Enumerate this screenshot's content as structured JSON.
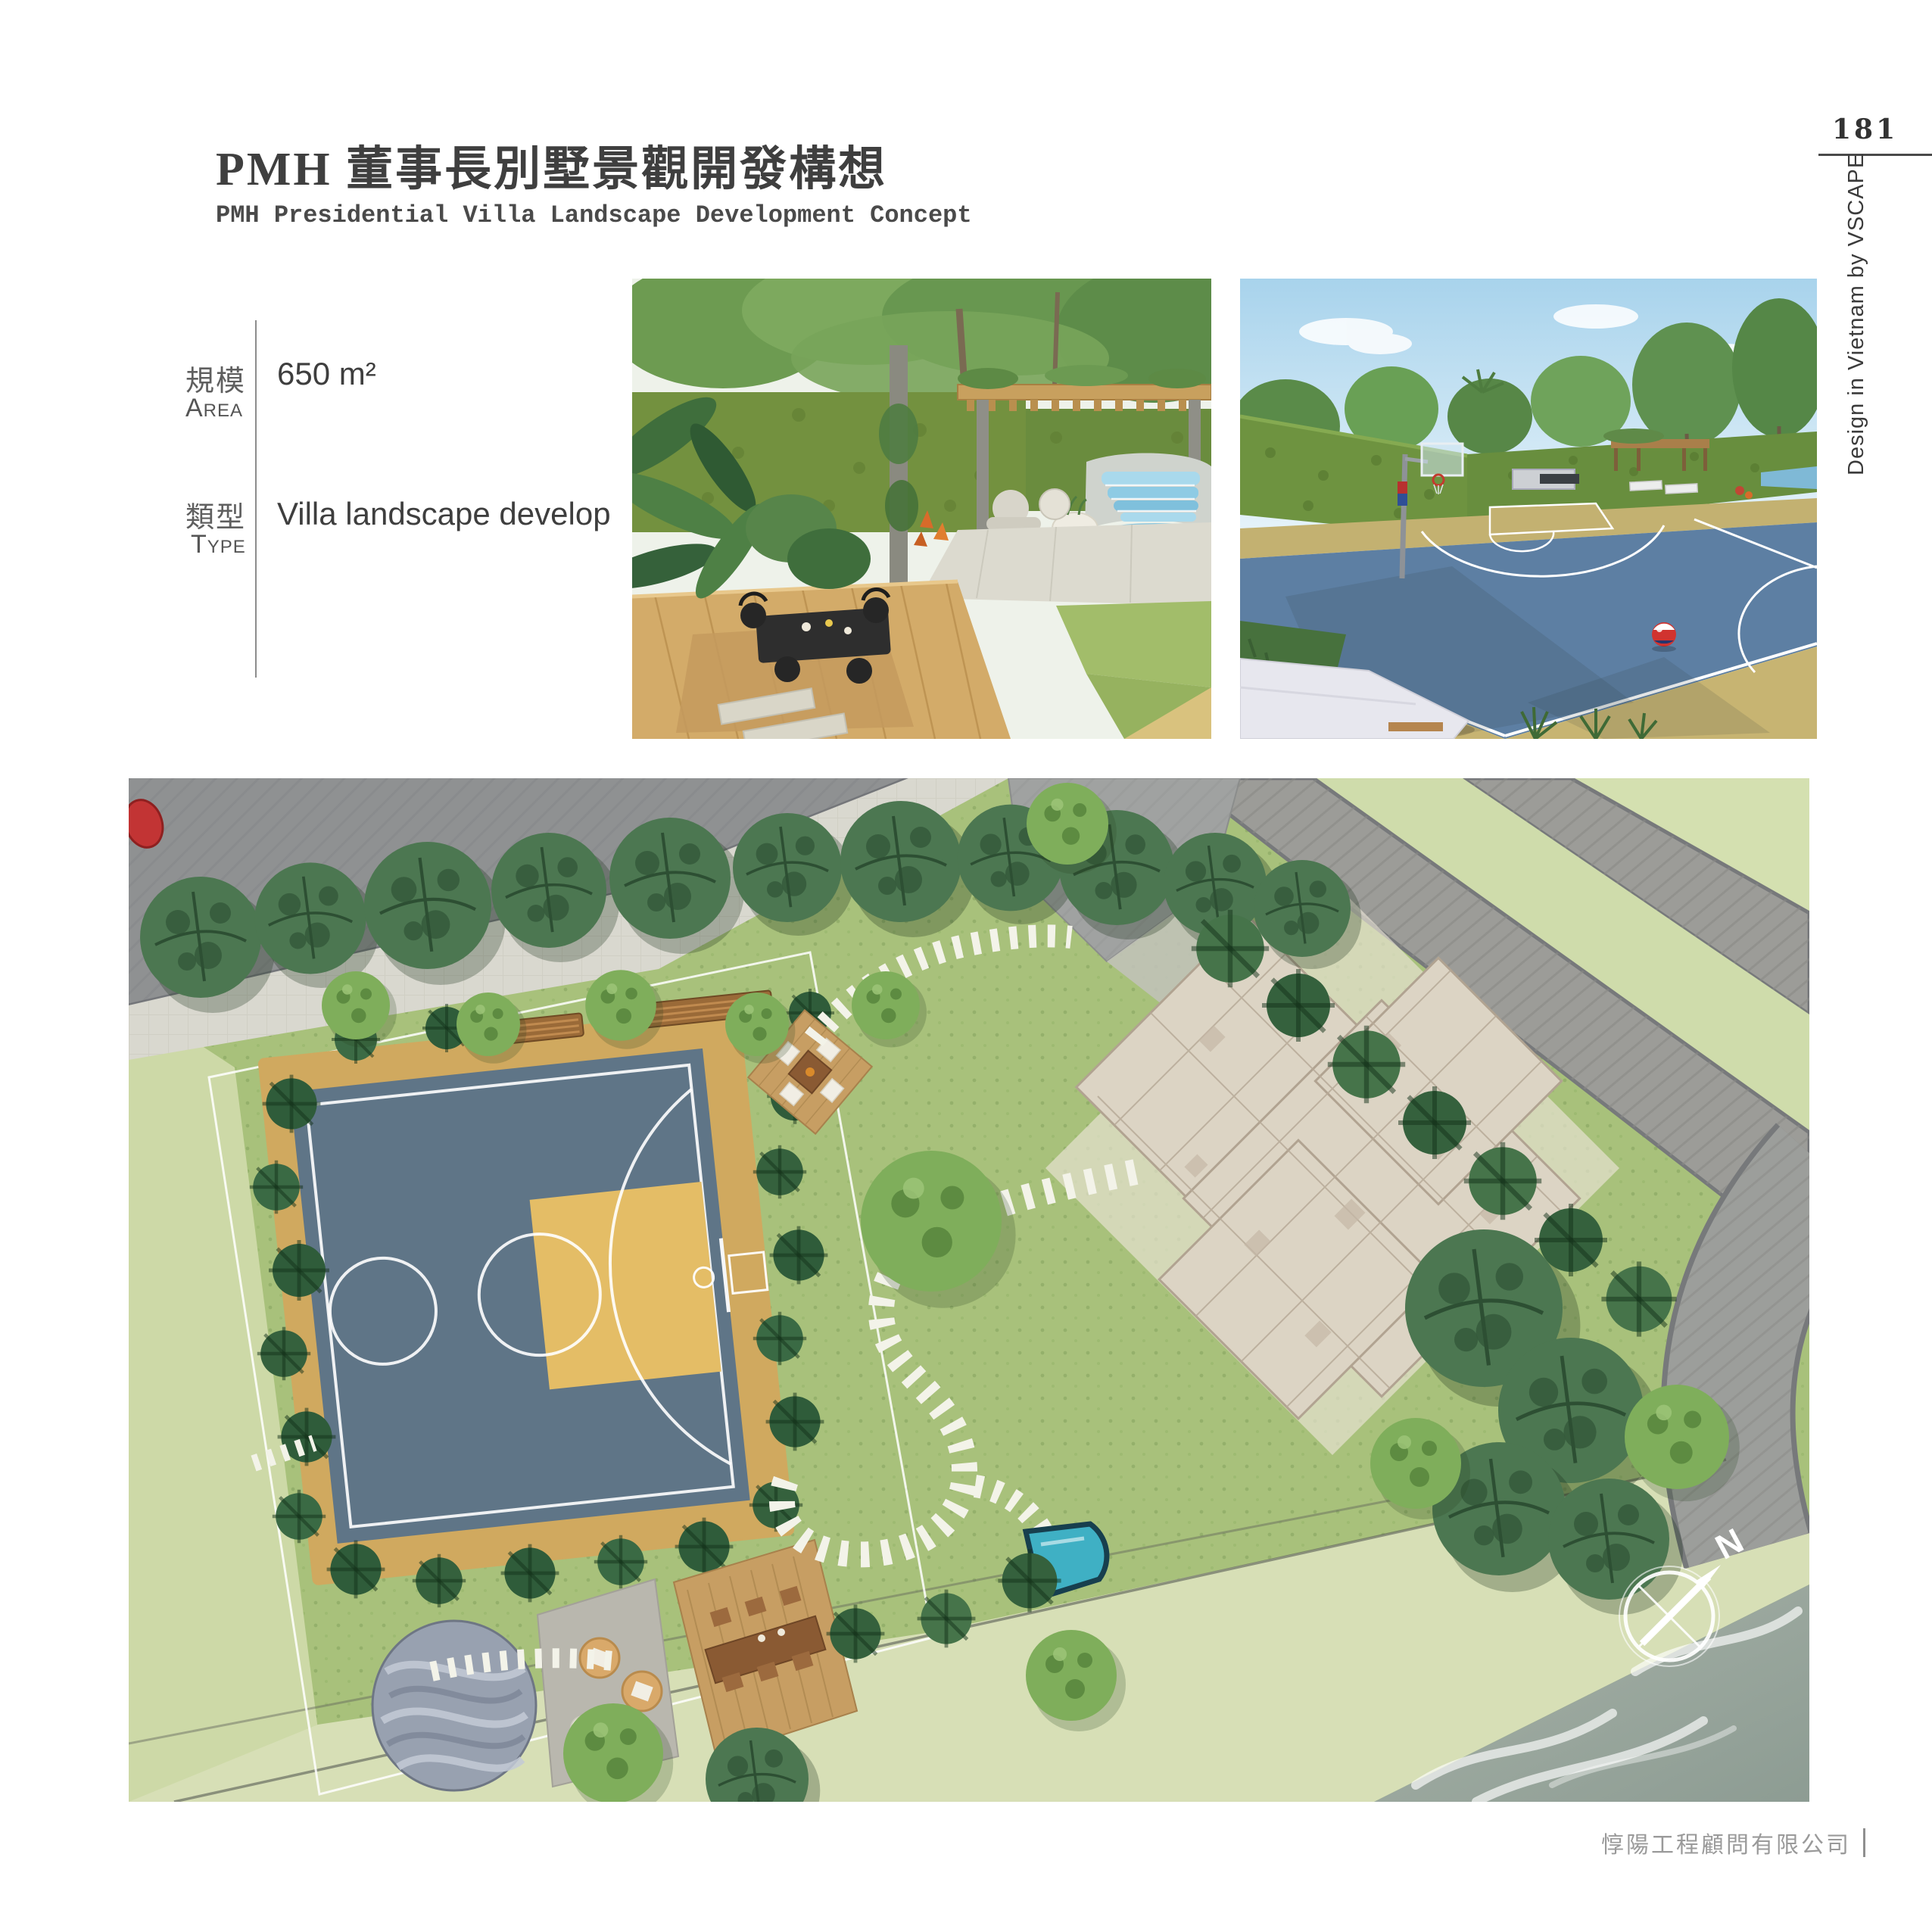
{
  "header": {
    "title_zh": "PMH 董事長別墅景觀開發構想",
    "title_en": "PMH Presidential Villa Landscape Development Concept"
  },
  "page": {
    "number": "181",
    "side_credit": "Design in Vietnam by VSCAPE",
    "footer_company": "惇陽工程顧問有限公司"
  },
  "meta": {
    "area": {
      "label_zh": "規模",
      "label_en": "Area",
      "value": "650 m²"
    },
    "type": {
      "label_zh": "類型",
      "label_en": "Type",
      "value": "Villa landscape develop"
    }
  },
  "siteplan": {
    "compass_north": "N"
  },
  "figures": {
    "garden_render": "Garden terrace with pergola, dining deck and waterfall pool",
    "court_render": "Backyard basketball court render",
    "siteplan": "Villa landscape master plan"
  },
  "palette": {
    "title_text": "#3f3f3f",
    "muted_text": "#9a9a9a",
    "court_blue": "#5f7587",
    "court_key_yellow": "#e4bd66",
    "court_apron_tan": "#d0a95f",
    "lawn_green": "#a8c17b",
    "pale_lawn": "#cdd9a7",
    "road_gray": "#919394",
    "house_beige": "#dcd4c4",
    "water_gray": "#97a59c",
    "pool_cyan": "#3fb0c4",
    "deck_wood": "#c79e63",
    "sky_blue": "#a8d3ec",
    "hedge_green": "#6e9340",
    "ball_red": "#d1332f"
  }
}
